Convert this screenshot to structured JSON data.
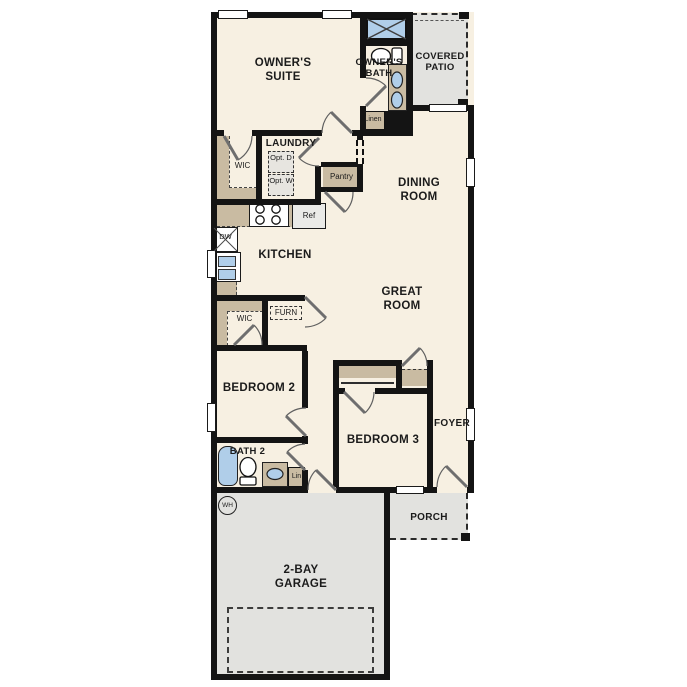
{
  "floorplan": {
    "labels": {
      "owners_suite": "OWNER'S SUITE",
      "owners_bath": "OWNER'S BATH",
      "covered_patio": "COVERED PATIO",
      "linen": "Linen",
      "wic_owners": "WIC",
      "laundry": "LAUNDRY",
      "opt_dryer": "Opt. D",
      "opt_washer": "Opt. W",
      "pantry": "Pantry",
      "dining_room": "DINING ROOM",
      "ref": "Ref",
      "dw": "DW",
      "kitchen": "KITCHEN",
      "great_room": "GREAT ROOM",
      "wic_bedroom2": "WIC",
      "furnace": "FURN",
      "bedroom2": "BEDROOM 2",
      "bath2": "BATH 2",
      "lin": "Lin",
      "bedroom3": "BEDROOM 3",
      "foyer": "FOYER",
      "porch": "PORCH",
      "garage": "2-BAY GARAGE",
      "water_heater": "WH"
    },
    "colors": {
      "floor": "#f7f0e2",
      "wall": "#141414",
      "closet": "#c9bba2",
      "concrete": "#e2e2df",
      "fixture": "#b0cee9",
      "appliance": "#eaeae7"
    }
  }
}
